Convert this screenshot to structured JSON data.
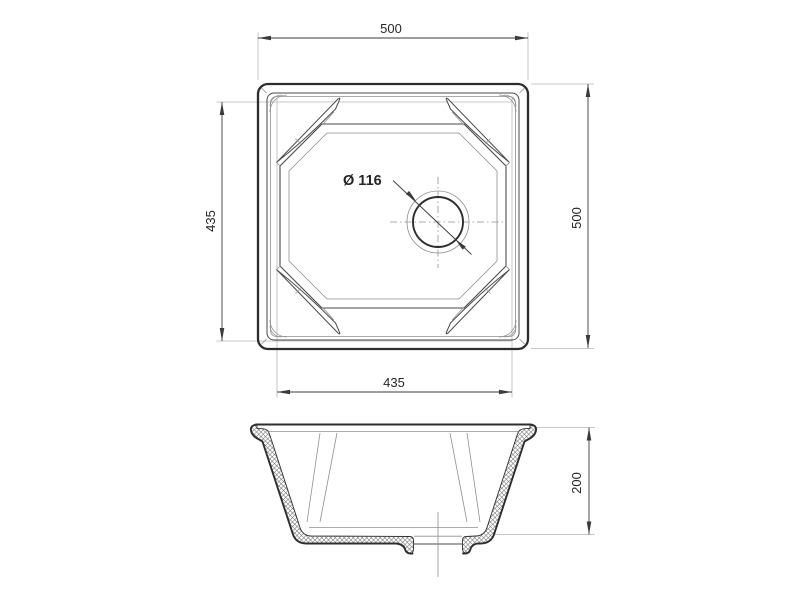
{
  "drawing": {
    "dimensions": {
      "overall_width": "500",
      "overall_depth": "500",
      "bowl_width": "435",
      "bowl_length": "435",
      "drain_diameter": "Ø 116",
      "bowl_height": "200"
    },
    "colors": {
      "outline": "#2d2d2d",
      "medium": "#4a4a4a",
      "light": "#8f8f8f",
      "extension": "#b6b6b6",
      "dimension": "#3a3a3a",
      "text": "#262626",
      "background": "#ffffff"
    }
  }
}
